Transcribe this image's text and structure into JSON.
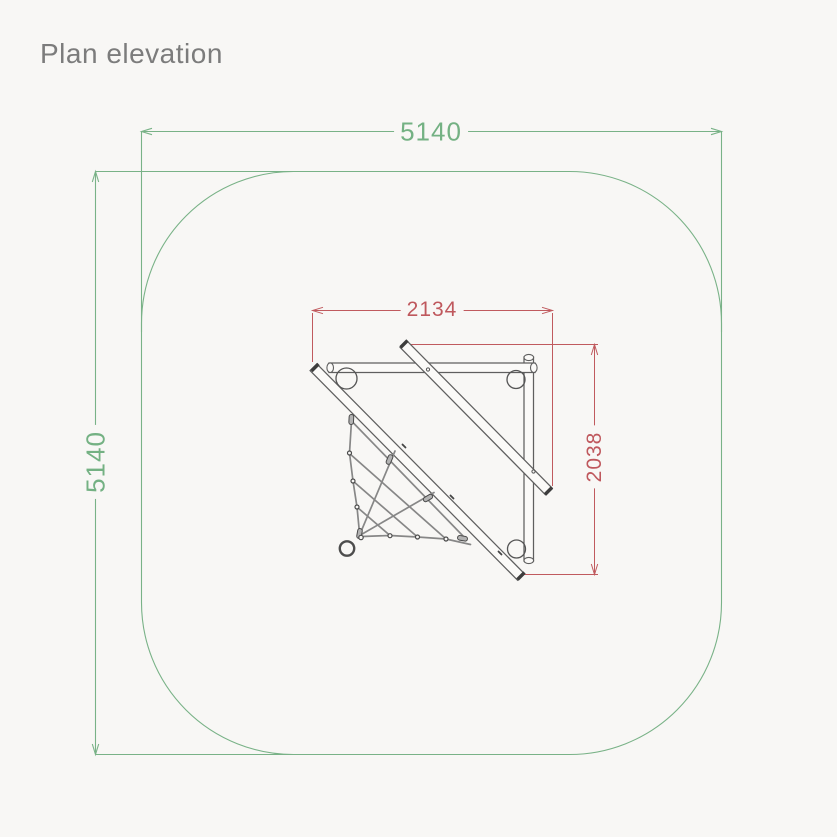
{
  "title": "Plan elevation",
  "labels": {
    "outer_width": "5140",
    "outer_height": "5140",
    "inner_width": "2134",
    "inner_depth": "2038"
  },
  "drawing": {
    "view": "plan",
    "safety_zone": {
      "width_mm": "5140",
      "height_mm": "5140"
    },
    "equipment": {
      "width_mm": "2134",
      "depth_mm": "2038"
    }
  },
  "colors": {
    "outer_dimension_green": "#74b183",
    "inner_dimension_red": "#bf585d",
    "equipment_gray": "#5f5f5f",
    "title_text": "#7c7c7c",
    "background": "#f8f7f5"
  }
}
